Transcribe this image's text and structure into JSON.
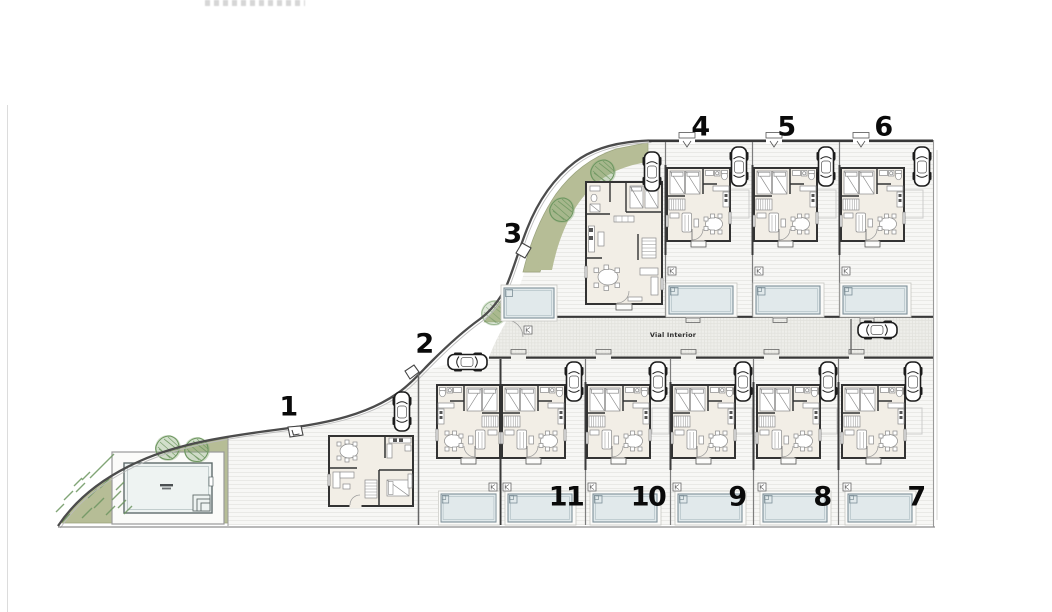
{
  "road": {
    "label": "Vial Interior"
  },
  "plots": [
    {
      "number": "1",
      "x": 288,
      "y": 407
    },
    {
      "number": "2",
      "x": 424,
      "y": 344
    },
    {
      "number": "3",
      "x": 512,
      "y": 234
    },
    {
      "number": "4",
      "x": 700,
      "y": 127
    },
    {
      "number": "5",
      "x": 786,
      "y": 127
    },
    {
      "number": "6",
      "x": 883,
      "y": 127
    },
    {
      "number": "7",
      "x": 916,
      "y": 497
    },
    {
      "number": "8",
      "x": 822,
      "y": 497
    },
    {
      "number": "9",
      "x": 737,
      "y": 497
    },
    {
      "number": "10",
      "x": 648,
      "y": 497
    },
    {
      "number": "11",
      "x": 566,
      "y": 497
    }
  ],
  "features": {
    "communal_pool": "communal-pool",
    "private_pools": 10,
    "houses": 11,
    "cars": 12,
    "trees": 4
  },
  "colors": {
    "green": "#b6bd96",
    "tree_stroke": "#6d9660",
    "pool_water": "#e1e9eb",
    "communal_water": "#eef3f2",
    "wall": "#383838",
    "interior_floor": "#f2eee6",
    "number_color": "#0a0a0a"
  }
}
